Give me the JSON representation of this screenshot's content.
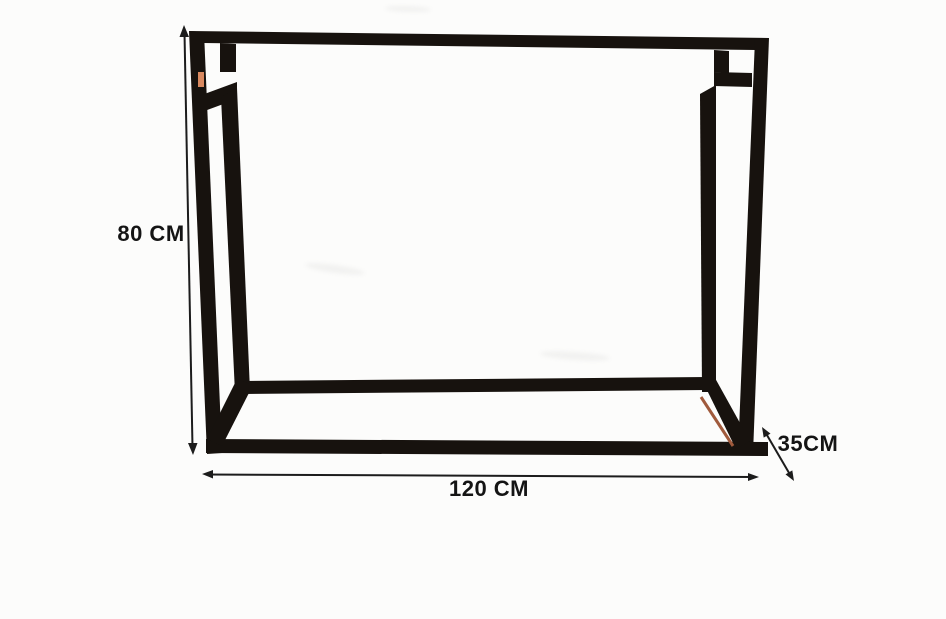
{
  "diagram": {
    "labels": {
      "height": "80 CM",
      "width": "120 CM",
      "depth": "35CM"
    },
    "colors": {
      "frame": "#17120e",
      "line": "#1c1c1c",
      "text": "#141414",
      "accent": "#d98960",
      "accent_dark": "#a05a3c",
      "background": "#fcfcfb"
    }
  }
}
